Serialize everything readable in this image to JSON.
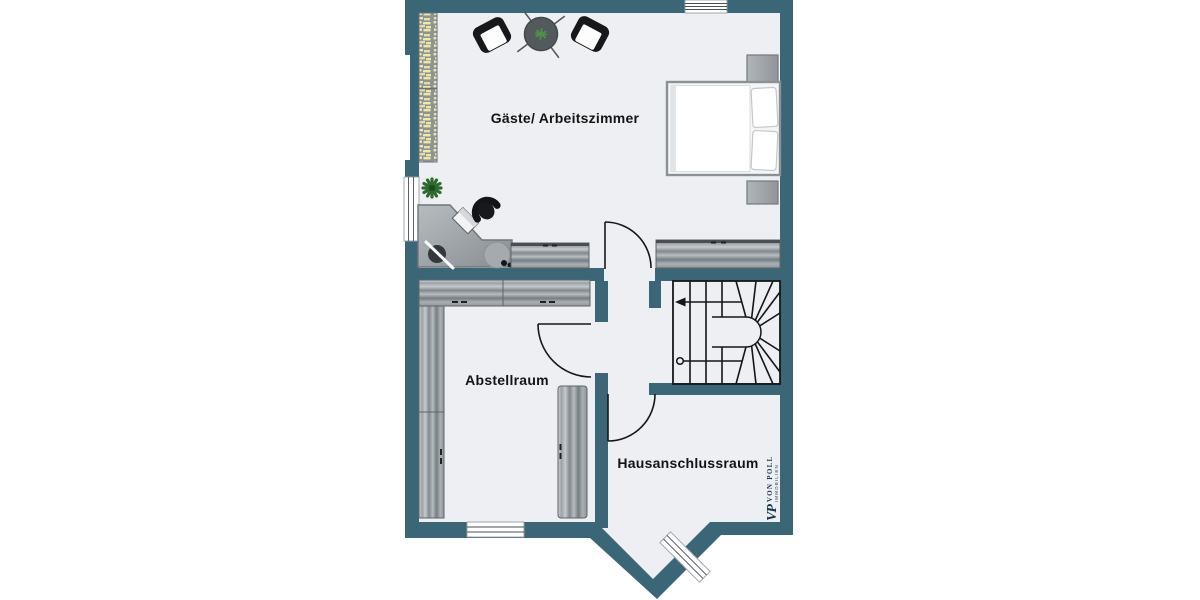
{
  "colors": {
    "wall": "#3B6678",
    "floor": "#EDEFF2",
    "line": "#14171A",
    "wood_light": "#CFD3D5",
    "wood_dark": "#767D81",
    "books_yellow": "#ECE5A5",
    "black_furniture": "#16181A",
    "plant_green": "#3F8F3F",
    "watermark": "#16384A",
    "window_white": "#FFFFFF"
  },
  "rooms": {
    "guest_room": {
      "label": "Gäste/ Arbeitszimmer"
    },
    "storage_room": {
      "label": "Abstellraum"
    },
    "utility_room": {
      "label": "Hausanschlussraum"
    }
  },
  "staircase": {
    "type": "winder-staircase",
    "direction_markers": [
      "start-circle",
      "exit-arrow-left"
    ]
  },
  "openings": {
    "doors": [
      "guest-room-door",
      "storage-room-door",
      "utility-room-door"
    ],
    "windows": [
      "top-window",
      "left-window",
      "storage-window",
      "bay-window"
    ]
  },
  "furniture": {
    "guest_room": [
      "bookshelf",
      "armchair-left",
      "round-side-table",
      "table-plant",
      "armchair-right",
      "double-bed",
      "nightstand-top",
      "nightstand-bottom",
      "potted-plant",
      "corner-desk",
      "office-chair",
      "laptop",
      "desk-lamp",
      "stool",
      "sideboard-left",
      "sideboard-right"
    ],
    "storage_room": [
      "wardrobe-top",
      "wardrobe-left",
      "wardrobe-right"
    ],
    "utility_room": []
  },
  "watermark": {
    "logo": "VP",
    "brand": "VON POLL",
    "subbrand": "IMMOBILIEN"
  }
}
